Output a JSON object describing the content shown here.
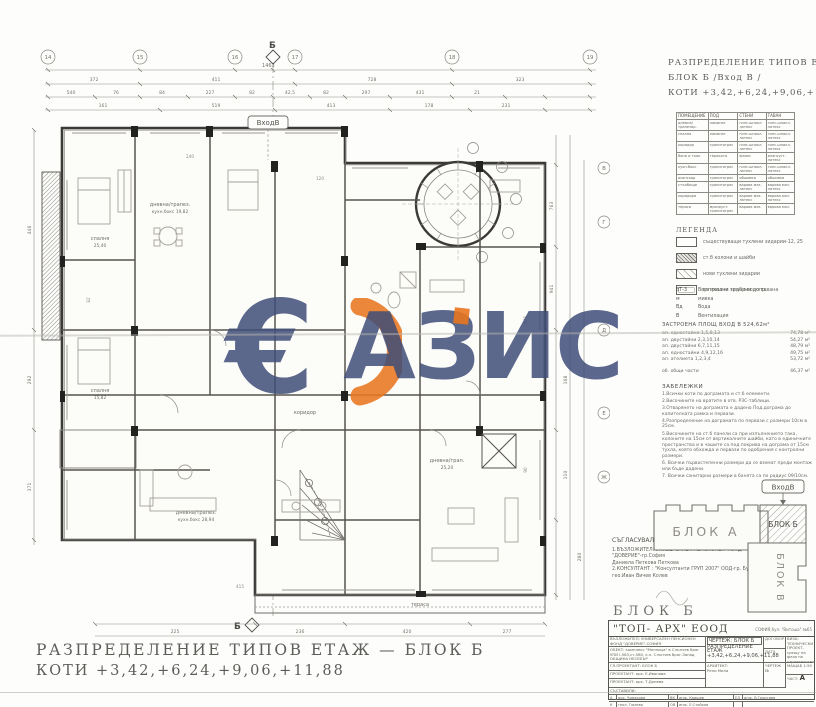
{
  "watermark": {
    "euro": "€",
    "text": "АЗИС",
    "navy": "#3e4c78",
    "orange": "#e8761f"
  },
  "plan": {
    "entrance_label": "ВходВ",
    "section_label": "Б",
    "dim_total": "1463",
    "axis_top": [
      "14",
      "15",
      "16",
      "17",
      "18",
      "19"
    ],
    "axis_right": [
      "В",
      "Г",
      "Д",
      "Е",
      "Ж"
    ],
    "chain1": [
      "372",
      "411",
      "728",
      "323"
    ],
    "chain2": [
      "540",
      "76",
      "84",
      "227",
      "82",
      "42,5",
      "82",
      "297",
      "431",
      "21"
    ],
    "chain3": [
      "161",
      "519",
      "413",
      "178",
      "231"
    ],
    "right_chain": [
      "763",
      "941",
      "168",
      "110",
      "280"
    ],
    "left_chain": [
      "446",
      "292",
      "371"
    ],
    "bottom_chain": [
      "225",
      "236",
      "420",
      "277"
    ],
    "rooms": [
      {
        "name": "спалня",
        "area": "25,40"
      },
      {
        "name": "дневна/трапез.",
        "area": "кухн.бокс 19,82"
      },
      {
        "name": "спалня",
        "area": "15,82"
      },
      {
        "name": "дневна/трапез.",
        "area": "кухн.бокс 28,94"
      },
      {
        "name": "дневна/трап.",
        "area": "25,20"
      },
      {
        "name": "баня",
        "area": "4,20"
      },
      {
        "name": "коридор",
        "area": ""
      },
      {
        "name": "тераса",
        "area": ""
      }
    ],
    "misc_dims": [
      "240",
      "120",
      "375",
      "415",
      "90",
      "82"
    ]
  },
  "rp": {
    "title1": "РАЗПРЕДЕЛЕНИЕ ТИПОВ ЕТАЖ",
    "title2": "БЛОК Б /Вход В /",
    "title3": "КОТИ +3,42,+6,24,+9,06,+11,88"
  },
  "finish_table": {
    "headers": [
      "ПОМЕЩЕНИЕ",
      "ПОД",
      "СТЕНИ",
      "ТАВАН"
    ],
    "rows": [
      [
        "дневна/ трапезар.",
        "ламинат",
        "гипс.шпакл. латекс",
        "гипс.шпакл. латекс"
      ],
      [
        "спалня",
        "ламинат",
        "гипс.шпакл. латекс",
        "гипс.шпакл. латекс"
      ],
      [
        "коридор",
        "гранитогрес",
        "гипс.шпакл. латекс",
        "гипс.шпакл. латекс"
      ],
      [
        "баня и тоал.",
        "теракота",
        "фаянс",
        "влагоуст. латекс"
      ],
      [
        "кухн.бокс",
        "гранитогрес",
        "гипс.шпакл. латекс",
        "гипс.шпакл. латекс"
      ],
      [
        "асансьор",
        "гранитогрес",
        "обшивка",
        "обшивка"
      ],
      [
        "стълбище",
        "гранитогрес",
        "варова маз. латекс",
        "варова маз. латекс"
      ],
      [
        "коридори",
        "гранитогрес",
        "варова маз. латекс",
        "варова маз. латекс"
      ],
      [
        "тераси",
        "мразоуст. гранитогрес",
        "варова маз.",
        "варова маз."
      ]
    ]
  },
  "legend": {
    "title": "ЛЕГЕНДА",
    "items": [
      "съществуващи тухлени зидарии-12, 25",
      "ст.б колони и шайби",
      "нови тухлени зидарии",
      "вътрешни зидарии до тавана"
    ],
    "utilities": [
      {
        "key": "ВТ-3",
        "text": "Вертикални тръби-водопр."
      },
      {
        "key": "м",
        "text": "мивка"
      },
      {
        "key": "Вд",
        "text": "Вода"
      },
      {
        "key": "В",
        "text": "Вентилация"
      }
    ]
  },
  "areas": {
    "title": "ЗАСТРОЕНА ПЛОЩ ВХОД В 524,62м²",
    "items": [
      {
        "label": "ап. едностайни 1,5,8,13",
        "value": "74,78 м²"
      },
      {
        "label": "ап. двустайни 2,3,10,14",
        "value": "54,27 м²"
      },
      {
        "label": "ап. двустайни 6,7,11,15",
        "value": "48,79 м²"
      },
      {
        "label": "ап. едностайни 4,9,12,16",
        "value": "49,75 м²"
      },
      {
        "label": "ап. ателиета 1,2,3,4",
        "value": "53,72 м²"
      }
    ],
    "common_label": "об. общи части",
    "common_value": "46,37 м²"
  },
  "notes": {
    "title": "ЗАБЕЛЕЖКИ",
    "items": [
      "1.Всички коти по дограмата и ст.б елементи.",
      "2.Височините на вратите в отв. РЗС-таблици.",
      "3.Отварянето на дограмата е дадено Под.дограма до капителната рамка и первази.",
      "4.Разпределение на дограмата по первази с размери 10см в 25см.",
      "5.Височините на ст.б панели са при изпълнението така, колоните на 15см от вертикалните шайби, като в единичните пространства и в чашите са под покрива на дограма от 15см тухла, която обхожда и первази по одобрения с контролни размери.",
      "6. Всички първостепенни размери да се вземат преди монтаж или бъде дадени.",
      "7. Всички санитарни размери в банята са по радиус 09/10см."
    ]
  },
  "keyplan": {
    "entrance": "ВходВ",
    "block_a": "БЛОК А",
    "block_b": "БЛОК Б",
    "block_v": "БЛОК В"
  },
  "approvals": {
    "title": "СЪГЛАСУВАЛИ:",
    "lines": [
      "1.ВЪЗЛОЖИТЕЛ: УНИВЕРСАЛЕН ПЕНСИОНЕН ФОНД",
      "\"ДОВЕРИЕ\"-гр.София",
      "Даниела Петкова Петкова",
      "2.КОНСУЛТАНТ : \"Консултанти ГРУП 2007\" ООД-гр. Бургас",
      "гео.Иван Вичев Колев"
    ]
  },
  "block_title": "БЛОК Б",
  "titleblock": {
    "company": "\"ТОП- АРХ\"  ЕООД",
    "address": "СОФИЯ,бул. \"Витоша\" №65",
    "client": "ВЪЗЛОЖИТЕЛ: УНИВЕРСАЛЕН ПЕНСИОНЕН ФОНД \"ДОВЕРИЕ\"-СОФИЯ",
    "object1": "ОБЕКТ: комплекс \"Мелница\" в Слънчев бряг",
    "object2": "УПИ I-583,ст.580, к.л. Слънчев бряг-Запад",
    "object3": "ОБЩИНА НЕСЕБЪР",
    "drawing_label": "ЧЕРТЕЖ: БЛОК Б",
    "drawing_name": "РАЗПРЕДЕЛЕНИЕ ЕТАЖ",
    "drawing_levels": "+3,42,+6,24,+9,06,+11,88",
    "contract": "ДОГОВОР",
    "date": "ДАТА",
    "visa": "ВИЗА: ТЕХНИЧЕСКИ ПРОЕКТ-срещу на фаза на строителство",
    "row_lead": "ГЛ.ПРОЕКТАНТ: БЛОК Б",
    "row_p1": "ПРОЕКТАНТ: арх. Е.Иванова",
    "row_p2": "ПРОЕКТАНТ: арх. Т.Донева",
    "architect_label": "АРХИТЕКТ:",
    "architect_name": "Рени Мила",
    "sheet_no": "ЧЕРТЕЖ №",
    "scale": "МАЩАБ 1:50",
    "part_label": "ЧАСТ:",
    "part_value": "А",
    "made_by": "СЪСТАВИЛИ:",
    "sig": [
      {
        "k": "А",
        "v": "арх. Чомакова"
      },
      {
        "k": "ВК",
        "v": "инж. Каишев"
      },
      {
        "k": "ЕЛ",
        "v": "инж. В.Георгиев"
      },
      {
        "k": "К",
        "v": "геол. Гюлева"
      },
      {
        "k": "ОВ",
        "v": "инж. Е.Стайков"
      }
    ]
  },
  "footer": {
    "line1": "РАЗПРЕДЕЛЕНИЕ ТИПОВ ЕТАЖ — БЛОК Б",
    "line2": "КОТИ +3,42,+6,24,+9,06,+11,88"
  }
}
